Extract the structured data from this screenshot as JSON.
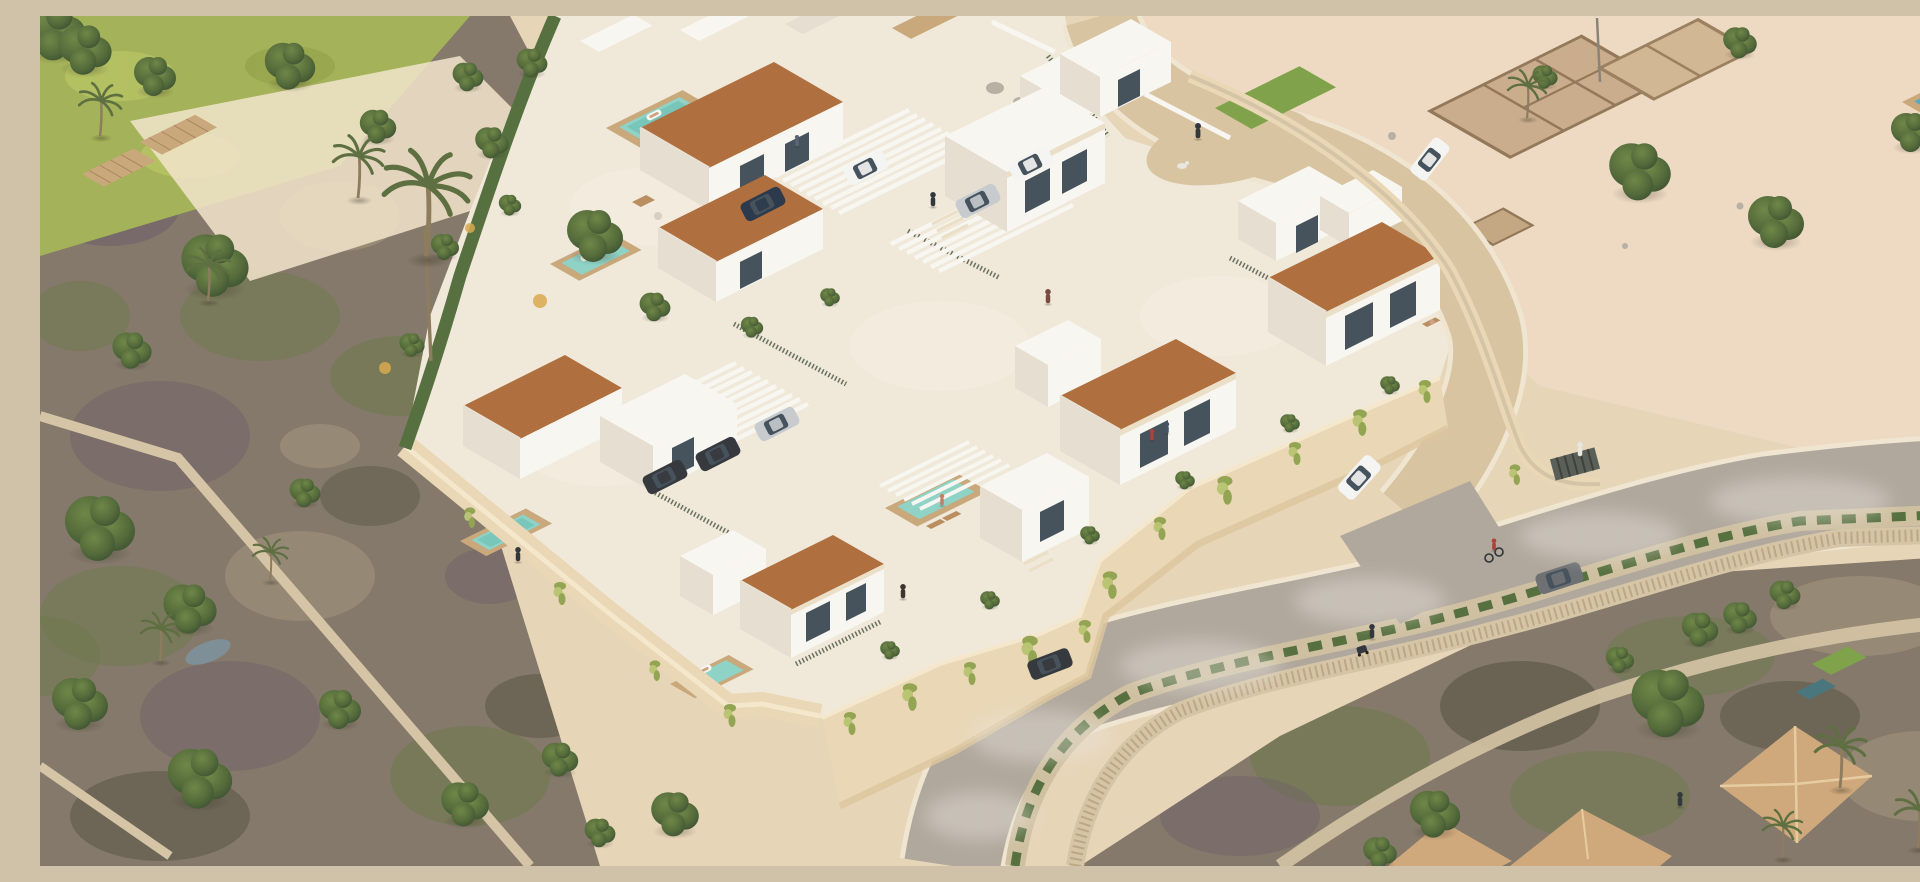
{
  "meta": {
    "type": "3d-architectural-rendering",
    "view": "aerial-isometric",
    "description": "Aerial isometric rendering of a walled Mediterranean residential development: two-storey white villas with terracotta shed roofs and private turquoise pools, white pergola carports with parked cars, a curved internal street with pedestrians and a dog, cream perimeter retaining walls draped with vines, an outer road with SUVs, a cyclist and walkers, sandy lots with ancient stone ruins to the upper right, overgrown green plots with palms to the left, and neighbouring tiled-roof houses at the lower right."
  },
  "palette": {
    "sand": "#e7d5b8",
    "sandPink": "#eedac3",
    "sandLight": "#f2e4cb",
    "terrace": "#f0e9da",
    "gravel": "#f6f0e2",
    "scrub": "#84796a",
    "scrubGreen": "#6d7a4b",
    "scrubPurple": "#6f5f6b",
    "scrubLight": "#a5987f",
    "scrubDark": "#4b4a3a",
    "grass": "#a4b259",
    "lawn": "#7fa24b",
    "roadOuter": "#b1a89d",
    "roadInner": "#d9c4a2",
    "curb": "#efe5d0",
    "smoke": "#e9e5de",
    "sidewalk": "#cfc0a1",
    "hedge": "#57703f",
    "stone": "#d5c4a5",
    "stoneDot": "#a78f6e",
    "wall": "#e9d7b6",
    "wallShade": "#dcc59e",
    "wallLit": "#f4e7cc",
    "white": "#f8f6f0",
    "whiteShade": "#e5ded1",
    "cream": "#ebdfc8",
    "glass": "#46525c",
    "roof": "#b06f3e",
    "roofDark": "#97602f",
    "roofNeighbor": "#cfa97c",
    "roofNeighborLine": "#e6cda1",
    "pool": "#8fd2c6",
    "poolDeep": "#60b9ab",
    "poolBlue": "#5aa7c2",
    "deck": "#c9a87c",
    "woodBox": "#b98f62",
    "treeDark": "#3c5031",
    "tree": "#546b3b",
    "treeLight": "#708748",
    "olive": "#5e6f41",
    "vine": "#93a452",
    "vineLight": "#b9c573",
    "trunk": "#8d7c5e",
    "boulder": "#b7b0a3",
    "pond": "#7e93a0",
    "carWhite": "#f4f4f2",
    "carSilver": "#c7cbce",
    "carDark": "#36393d",
    "carNavy": "#2c3a4d",
    "figDark": "#33383f",
    "figRed": "#b04038",
    "figWhite": "#e8e6e0",
    "skin": "#cfa183",
    "shadow": "#433a2c"
  },
  "scene": {
    "development": {
      "terracotta_roof_villas": 6,
      "white_flat_roof_volumes": 6,
      "private_pools": 5,
      "pool_floats_with_sunbathers": 3,
      "pergola_carports": 2,
      "parked_cars": 7,
      "internal_street": "curved, sand-coloured, with entrance gate at east corner",
      "perimeter": "cream retaining walls with hanging vines and hedges"
    },
    "outer_road": {
      "vehicles": [
        "white-suv",
        "grey-suv",
        "dark-sedan"
      ],
      "cyclists": 1,
      "pedestrians": 4,
      "dog_walker": 1,
      "stroller": 1,
      "sidewalk_hedge": true,
      "stone_retaining_walls": 2
    },
    "surroundings": {
      "ruin_foundations_lot": true,
      "flag_pole": 1,
      "neighbor_tiled_roofs": 3,
      "neighbor_pools": 2,
      "overgrown_plots_left": true,
      "boardwalk_decks": 2,
      "small_pond": 1,
      "palm_trees": 10,
      "round_trees": "about 40"
    }
  }
}
